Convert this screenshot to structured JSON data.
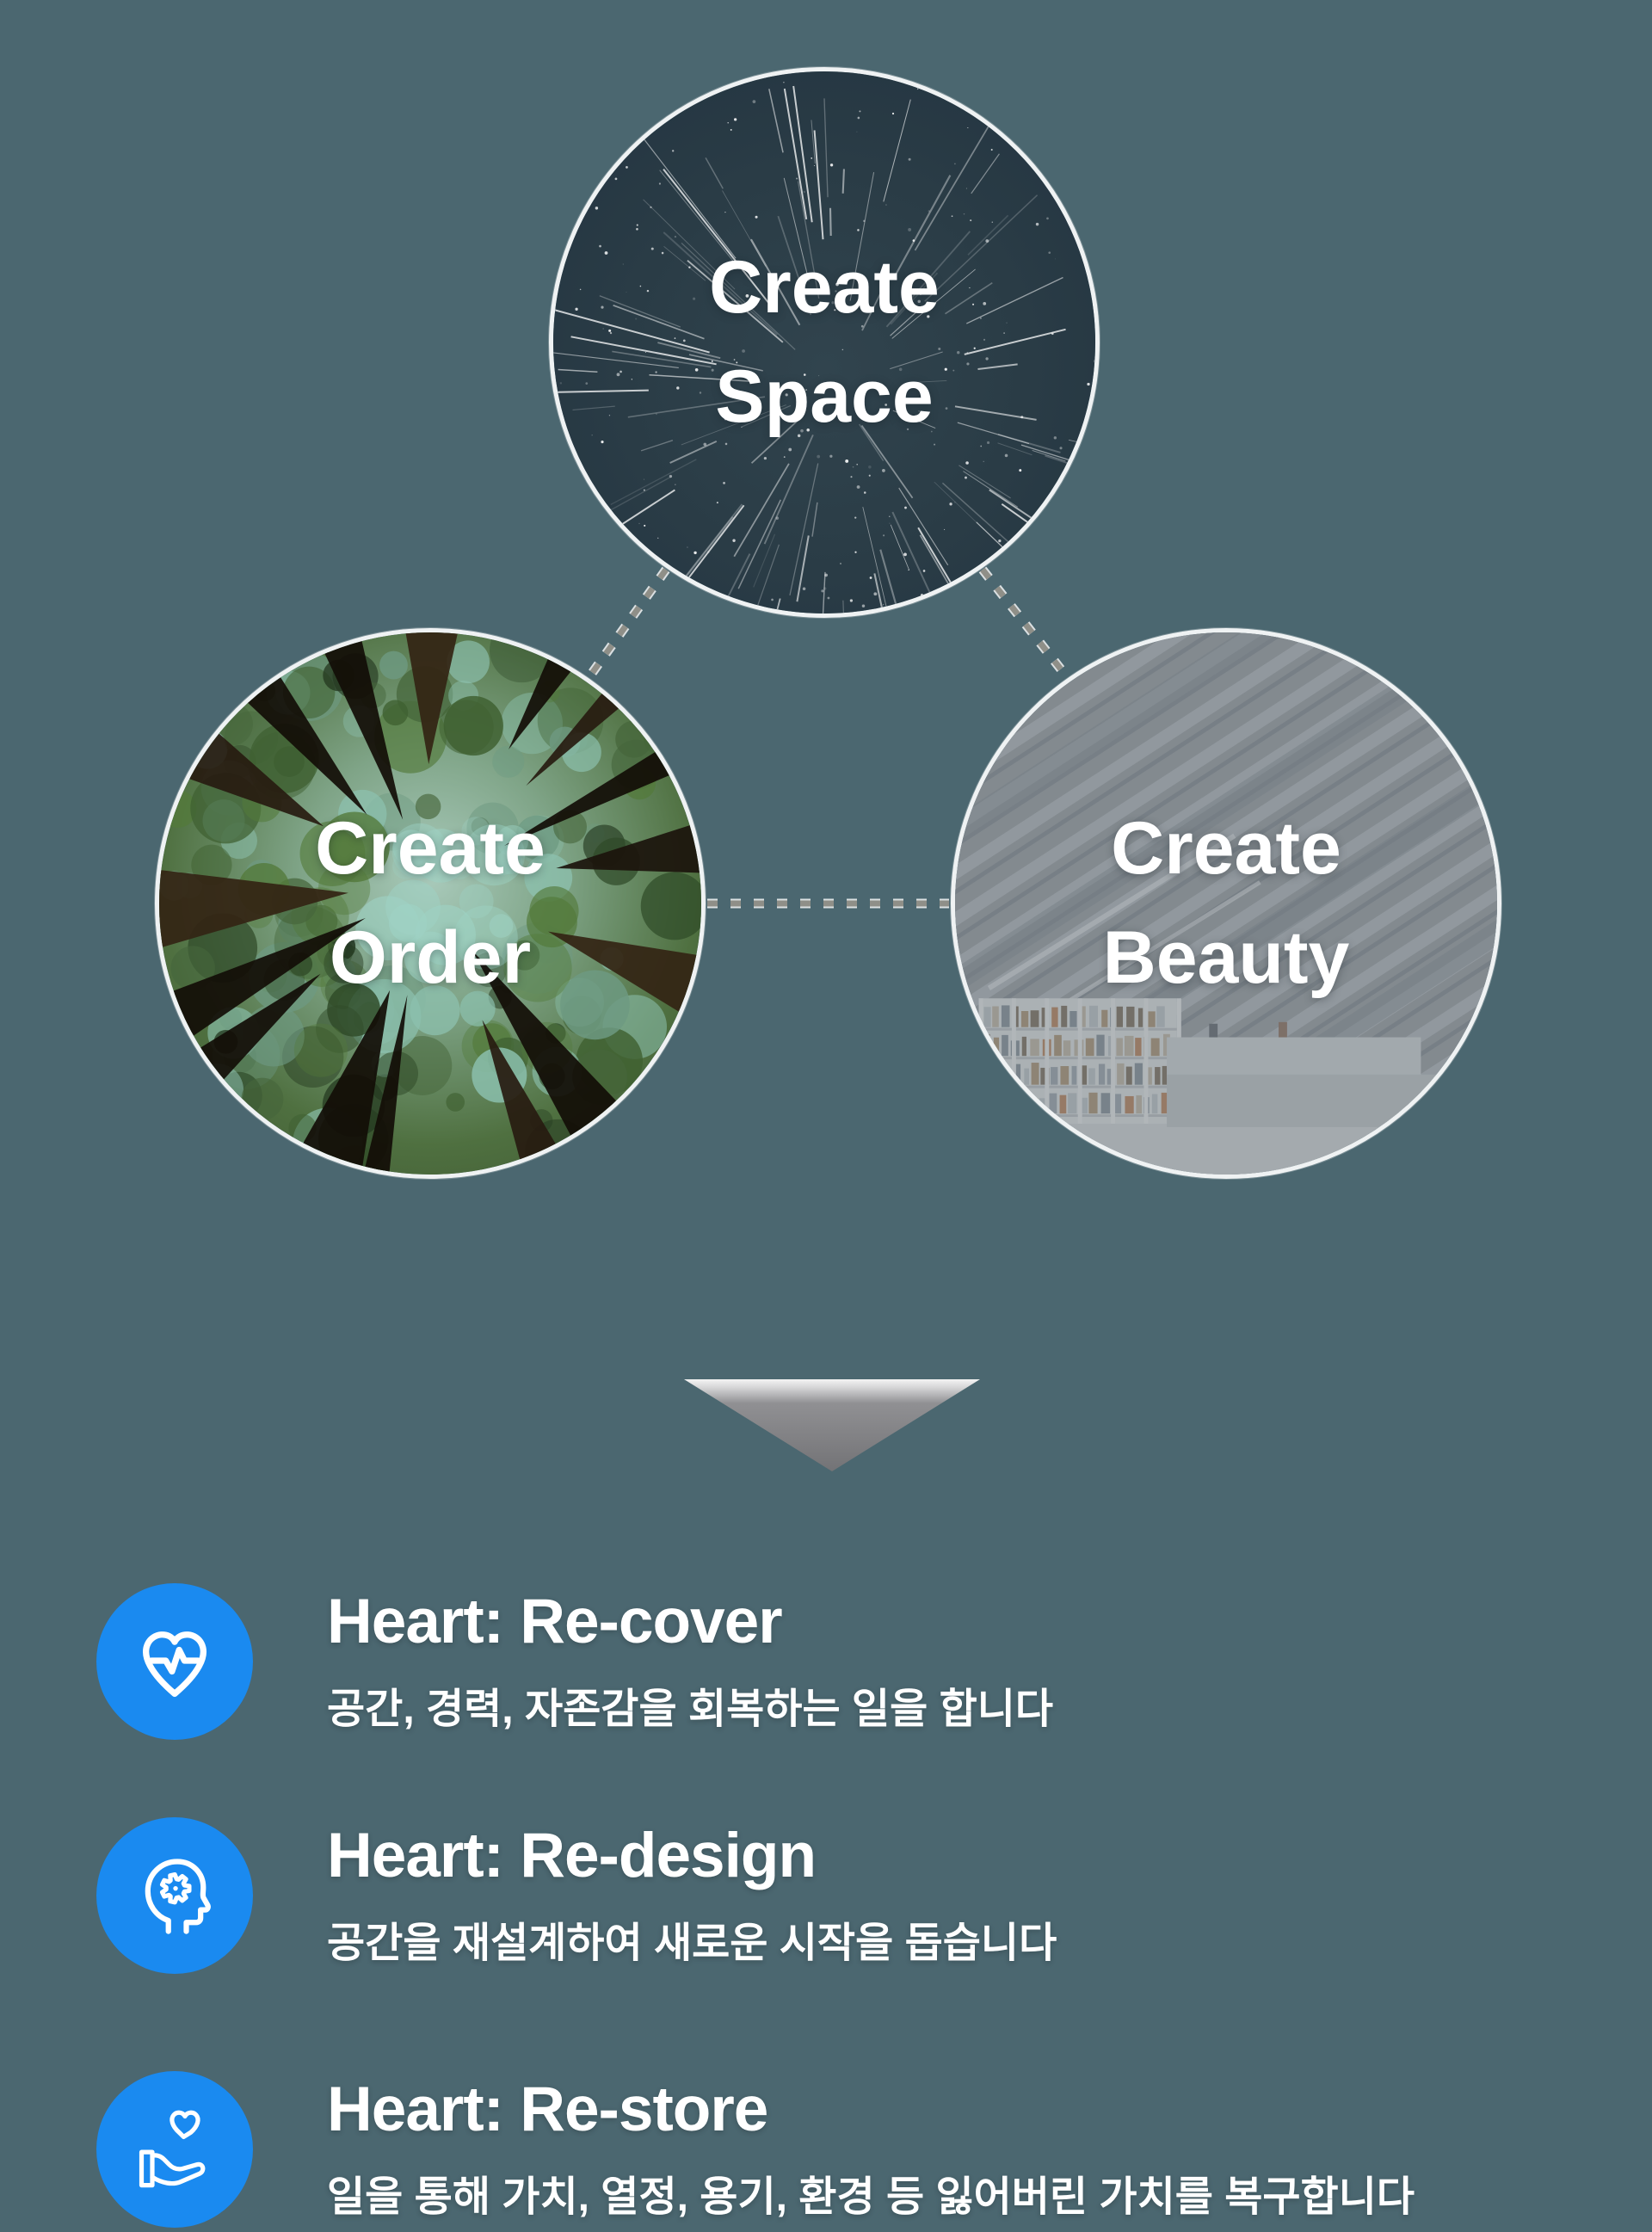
{
  "colors": {
    "background": "#4b6770",
    "accent_blue": "#1a8af0",
    "dash_gray": "#8f8f88",
    "circle_ring": "#f5f5f5"
  },
  "circles": [
    {
      "name": "create-space",
      "line1": "Create",
      "line2": "Space",
      "image": "starfield"
    },
    {
      "name": "create-order",
      "line1": "Create",
      "line2": "Order",
      "image": "forest-canopy"
    },
    {
      "name": "create-beauty",
      "line1": "Create",
      "line2": "Beauty",
      "image": "modern-architecture"
    }
  ],
  "features": [
    {
      "icon": "heart-pulse-icon",
      "title": "Heart: Re-cover",
      "description": "공간, 경력, 자존감을 회복하는 일을 합니다"
    },
    {
      "icon": "head-gear-icon",
      "title": "Heart: Re-design",
      "description": "공간을 재설계하여 새로운 시작을 돕습니다"
    },
    {
      "icon": "hand-heart-icon",
      "title": "Heart: Re-store",
      "description": "일을 통해 가치, 열정, 용기, 환경 등 잃어버린 가치를 복구합니다"
    }
  ]
}
